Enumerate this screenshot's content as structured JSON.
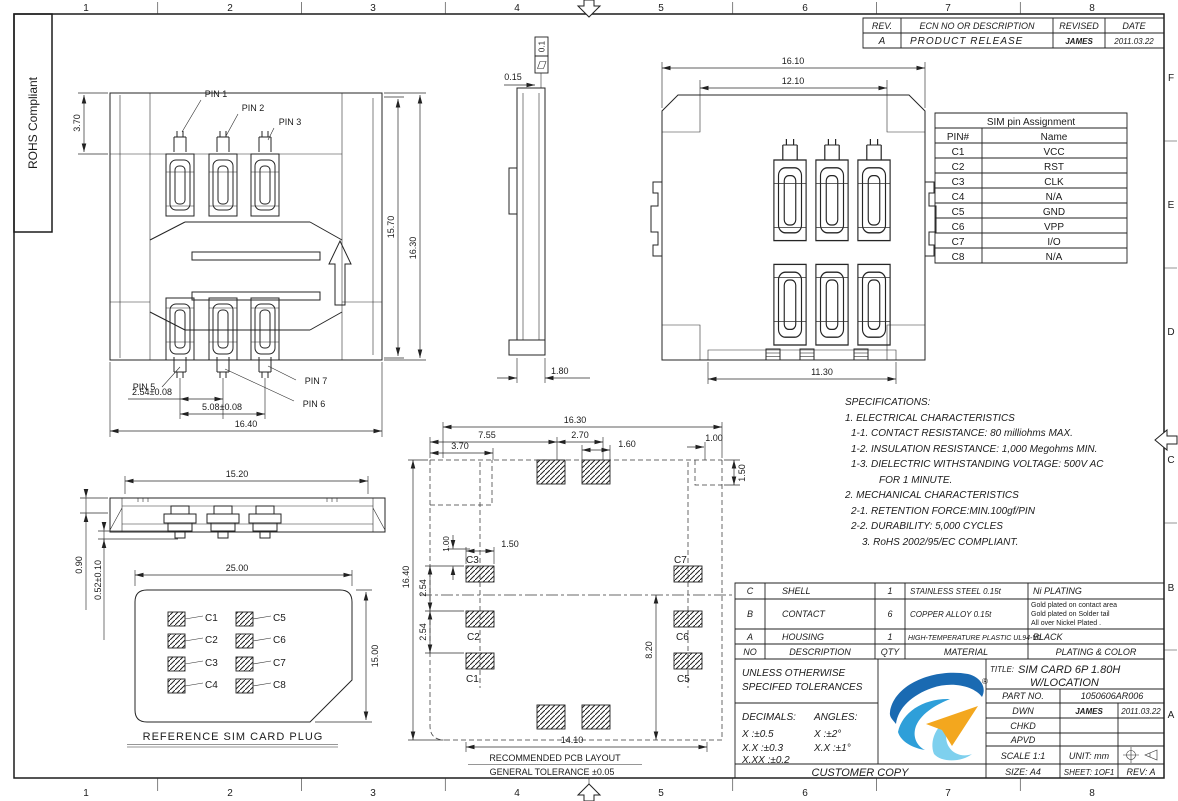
{
  "sheet": {
    "rohs_label": "ROHS Compliant",
    "zone_columns": [
      "1",
      "2",
      "3",
      "4",
      "5",
      "6",
      "7",
      "8"
    ],
    "zone_rows": [
      "F",
      "E",
      "D",
      "C",
      "B",
      "A"
    ]
  },
  "revision_table": {
    "col_rev": "REV.",
    "col_desc": "ECN NO OR DESCRIPTION",
    "col_revised": "REVISED",
    "col_date": "DATE",
    "row": {
      "rev": "A",
      "desc": "PRODUCT RELEASE",
      "revised": "JAMES",
      "date": "2011.03.22"
    }
  },
  "pin_table": {
    "title": "SIM pin Assignment",
    "col_pin": "PIN#",
    "col_name": "Name",
    "rows": [
      {
        "pin": "C1",
        "name": "VCC"
      },
      {
        "pin": "C2",
        "name": "RST"
      },
      {
        "pin": "C3",
        "name": "CLK"
      },
      {
        "pin": "C4",
        "name": "N/A"
      },
      {
        "pin": "C5",
        "name": "GND"
      },
      {
        "pin": "C6",
        "name": "VPP"
      },
      {
        "pin": "C7",
        "name": "I/O"
      },
      {
        "pin": "C8",
        "name": "N/A"
      }
    ]
  },
  "specifications": {
    "l0": "SPECIFICATIONS:",
    "l1": "1. ELECTRICAL CHARACTERISTICS",
    "l2": "1-1. CONTACT RESISTANCE: 80 milliohms MAX.",
    "l3": "1-2. INSULATION RESISTANCE: 1,000 Megohms MIN.",
    "l4": "1-3. DIELECTRIC WITHSTANDING VOLTAGE: 500V AC",
    "l5": "FOR 1 MINUTE.",
    "l6": "2. MECHANICAL CHARACTERISTICS",
    "l7": "2-1. RETENTION FORCE:MIN.100gf/PIN",
    "l8": "2-2. DURABILITY: 5,000 CYCLES",
    "l9": "3. RoHS 2002/95/EC COMPLIANT."
  },
  "material_table": {
    "h_no": "NO",
    "h_desc": "DESCRIPTION",
    "h_qty": "QTY",
    "h_mat": "MATERIAL",
    "h_plat": "PLATING & COLOR",
    "rows": [
      {
        "no": "C",
        "desc": "SHELL",
        "qty": "1",
        "mat": "STAINLESS STEEL 0.15t",
        "plat": "Ni PLATING"
      },
      {
        "no": "B",
        "desc": "CONTACT",
        "qty": "6",
        "mat": "COPPER ALLOY 0.15t",
        "plat": ""
      },
      {
        "no": "A",
        "desc": "HOUSING",
        "qty": "1",
        "mat": "HIGH-TEMPERATURE PLASTIC UL94-V0",
        "plat": "BLACK"
      }
    ],
    "contact_plating_1": "Gold plated on contact area",
    "contact_plating_2": "Gold plated on Solder tail",
    "contact_plating_3": "All over Nickel Plated ."
  },
  "title_block": {
    "tol_line1": "UNLESS OTHERWISE",
    "tol_line2": "SPECIFED TOLERANCES",
    "decimals_label": "DECIMALS:",
    "angles_label": "ANGLES:",
    "dec1": "X :±0.5",
    "ang1": "X :±2°",
    "dec2": "X.X :±0.3",
    "ang2": "X.X :±1°",
    "dec3": "X.XX :±0.2",
    "customer_copy": "CUSTOMER COPY",
    "title_label": "TITLE:",
    "title_line1": "SIM CARD 6P 1.80H",
    "title_line2": "W/LOCATION",
    "part_no_label": "PART NO.",
    "part_no_value": "1050606AR006",
    "drawn_label": "DWN",
    "drawn_by": "JAMES",
    "drawn_date": "2011.03.22",
    "checked_label": "CHKD",
    "approved_label": "APVD",
    "scale_label": "SCALE 1:1",
    "unit_label": "UNIT: mm",
    "size_label": "SIZE: A4",
    "sheet_label": "SHEET: 1OF1",
    "rev_label": "REV: A",
    "logo_reg": "®"
  },
  "front_view": {
    "pin1": "PIN 1",
    "pin2": "PIN 2",
    "pin3": "PIN 3",
    "pin5": "PIN 5",
    "pin6": "PIN 6",
    "pin7": "PIN 7",
    "dim_step": "3.70",
    "dim_inner_height": "15.70",
    "dim_height": "16.30",
    "dim_pitch": "2.54±0.08",
    "dim_pitch2": "5.08±0.08",
    "dim_width": "16.40"
  },
  "side_view": {
    "dim_gap": "0.15",
    "flatness": "0.1",
    "dim_foot": "1.80"
  },
  "open_view": {
    "dim_width": "16.10",
    "dim_opening": "12.10",
    "dim_bottom": "11.30"
  },
  "profile_view": {
    "dim_width": "15.20",
    "dim_height": "0.90",
    "dim_tail": "0.52±0.10"
  },
  "card_view": {
    "dim_width": "25.00",
    "dim_height": "15.00",
    "c1": "C1",
    "c2": "C2",
    "c3": "C3",
    "c4": "C4",
    "c5": "C5",
    "c6": "C6",
    "c7": "C7",
    "c8": "C8",
    "caption": "REFERENCE SIM CARD PLUG"
  },
  "pcb_view": {
    "dim_total_w": "16.30",
    "dim_755": "7.55",
    "dim_370": "3.70",
    "dim_270": "2.70",
    "dim_160": "1.60",
    "dim_100_top": "1.00",
    "dim_150_right": "1.50",
    "dim_100_left": "1.00",
    "dim_150_pad": "1.50",
    "dim_254_a": "2.54",
    "dim_254_b": "2.54",
    "dim_total_h": "16.40",
    "dim_820": "8.20",
    "dim_1410": "14.10",
    "c1": "C1",
    "c2": "C2",
    "c3": "C3",
    "c5": "C5",
    "c6": "C6",
    "c7": "C7",
    "caption": "RECOMMENDED PCB LAYOUT",
    "tolerance_note": "GENERAL TOLERANCE ±0.05"
  }
}
